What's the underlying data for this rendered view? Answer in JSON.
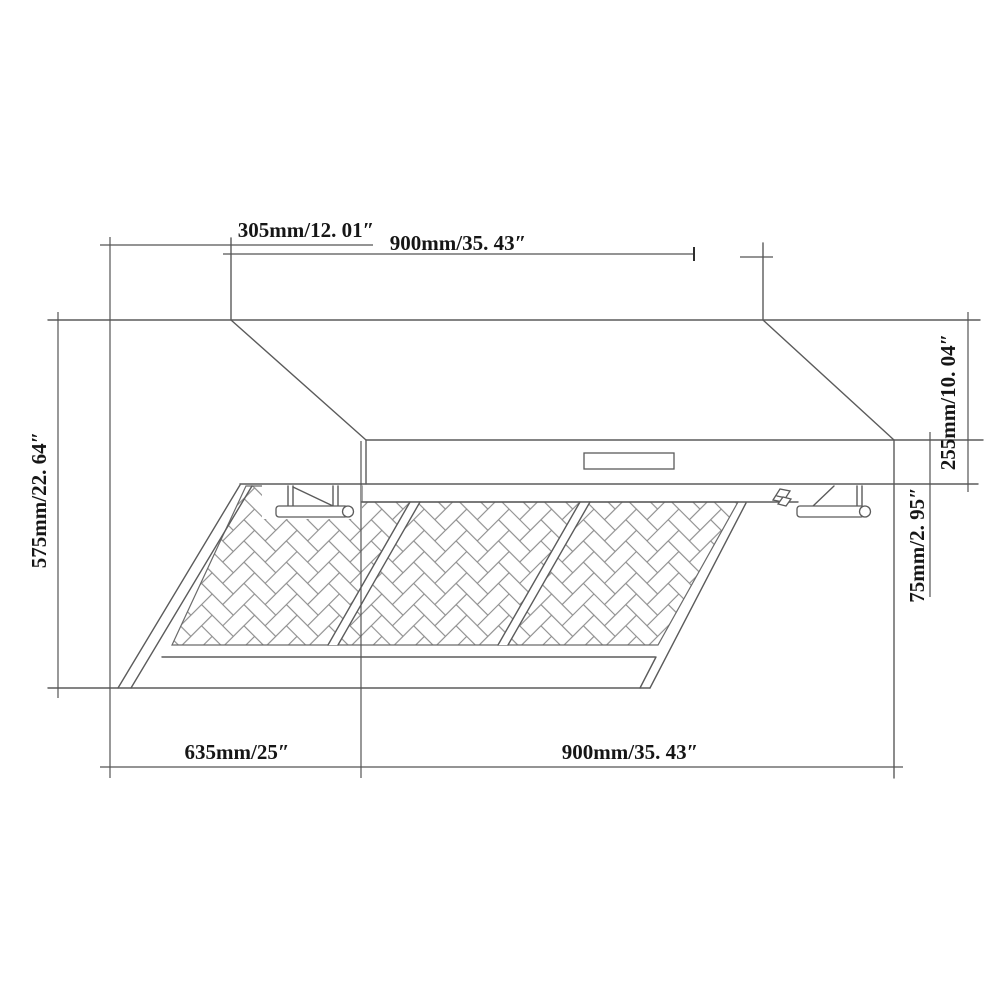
{
  "drawing": {
    "subject": "range-hood-dimension-diagram",
    "view": "front elevation line drawing",
    "labels": {
      "top_offset": "305mm/12. 01″",
      "top_width": "900mm/35. 43″",
      "overall_height": "575mm/22. 64″",
      "upper_right_height": "255mm/10. 04″",
      "lower_right_height": "75mm/2. 95″",
      "bottom_depth": "635mm/25″",
      "bottom_width": "900mm/35. 43″"
    },
    "colors": {
      "background": "#ffffff",
      "line": "#5b5b5b",
      "dimension_line": "#555555",
      "text": "#161616",
      "mesh_stroke": "#8d8d8d"
    }
  }
}
